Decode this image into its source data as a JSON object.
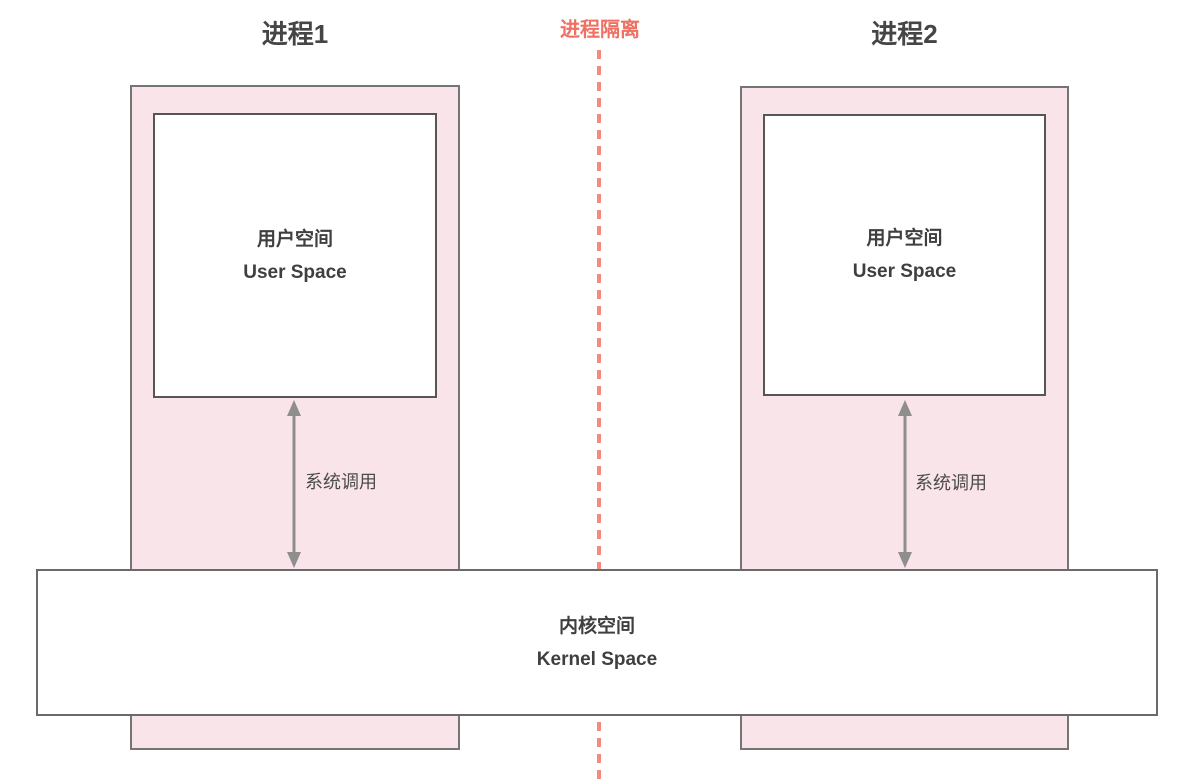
{
  "diagram": {
    "divider": {
      "label": "进程隔离"
    },
    "process1": {
      "title": "进程1",
      "user_space": {
        "line1": "用户空间",
        "line2": "User Space"
      },
      "syscall_label": "系统调用"
    },
    "process2": {
      "title": "进程2",
      "user_space": {
        "line1": "用户空间",
        "line2": "User Space"
      },
      "syscall_label": "系统调用"
    },
    "kernel": {
      "line1": "内核空间",
      "line2": "Kernel Space"
    },
    "colors": {
      "process_fill": "#f9e4e9",
      "box_border": "#757575",
      "inner_border": "#565656",
      "kernel_border": "#6a6a6a",
      "divider_red": "#ef7164",
      "divider_dash": "#f28b80",
      "arrow_gray": "#8e8e8e",
      "text_heading": "#454545",
      "text_dark": "#3f3f3f",
      "text_syscall": "#4c4c4c"
    }
  }
}
